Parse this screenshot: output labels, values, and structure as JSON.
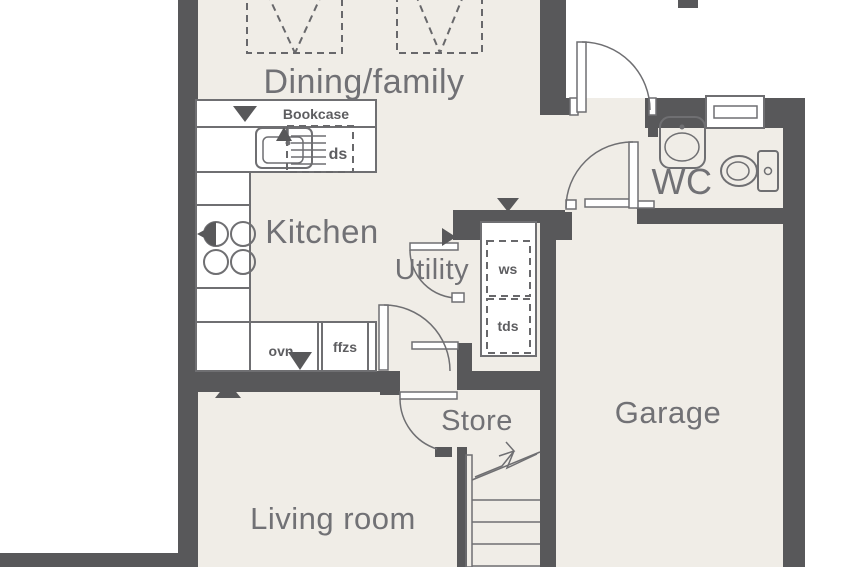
{
  "plan": {
    "rooms": {
      "dining": "Dining/family",
      "kitchen": "Kitchen",
      "utility": "Utility",
      "wc": "WC",
      "store": "Store",
      "garage": "Garage",
      "living": "Living room"
    },
    "fixtures": {
      "bookcase": "Bookcase",
      "dishwasher": "ds",
      "washer_space": "ws",
      "tumble_dryer_space": "tds",
      "oven": "ovn",
      "fridge_freezer_space": "ffzs"
    },
    "icons": [
      "sink-icon",
      "hob-icon",
      "extractor-icon",
      "basin-icon",
      "toilet-icon",
      "window-icon",
      "stairs-icon",
      "stairs-up-arrow-icon",
      "door-swing-icon",
      "rooflight-icon",
      "direction-triangle-icon"
    ],
    "colors": {
      "wall": "#58585a",
      "floor": "#f0ede7",
      "outside": "#ffffff",
      "line": "#6f6f72",
      "room_label": "#717175",
      "fixture_label": "#5d5d60"
    }
  }
}
